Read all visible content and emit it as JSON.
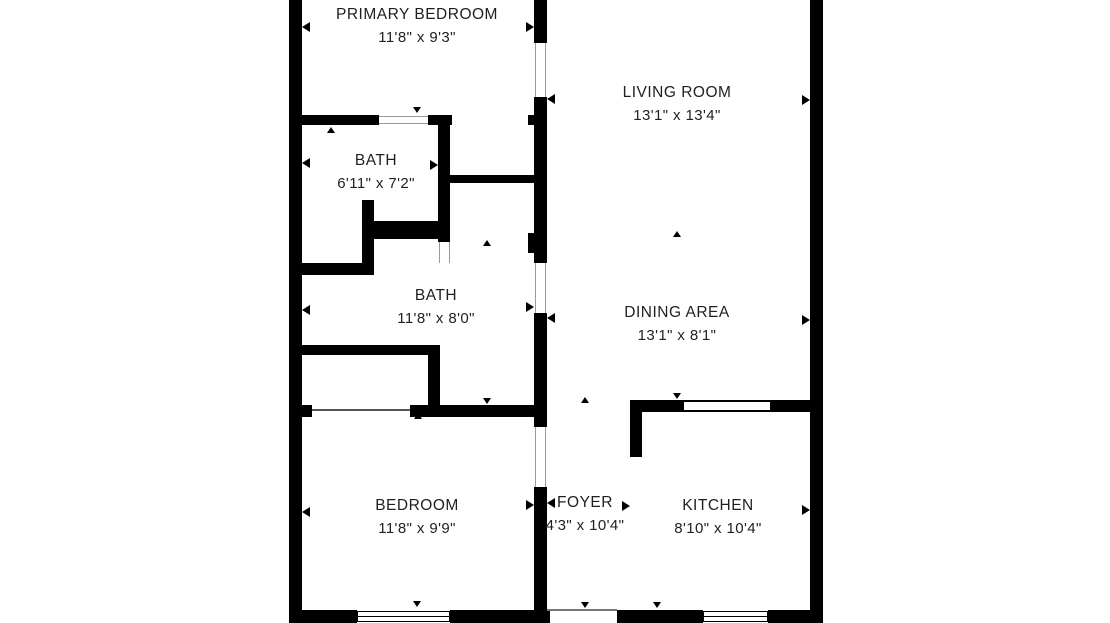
{
  "title": "Apartment floor plan",
  "plan": {
    "background_color": "#ffffff",
    "wall_color": "#000000",
    "label_color": "#1f1f1f"
  },
  "rooms": [
    {
      "name": "PRIMARY BEDROOM",
      "dimensions": "11'8\" x 9'3\""
    },
    {
      "name": "LIVING ROOM",
      "dimensions": "13'1\" x 13'4\""
    },
    {
      "name": "BATH",
      "dimensions": "6'11\" x 7'2\""
    },
    {
      "name": "BATH",
      "dimensions": "11'8\" x 8'0\""
    },
    {
      "name": "DINING AREA",
      "dimensions": "13'1\" x 8'1\""
    },
    {
      "name": "BEDROOM",
      "dimensions": "11'8\" x 9'9\""
    },
    {
      "name": "FOYER",
      "dimensions": "4'3\" x 10'4\""
    },
    {
      "name": "KITCHEN",
      "dimensions": "8'10\" x 10'4\""
    }
  ]
}
